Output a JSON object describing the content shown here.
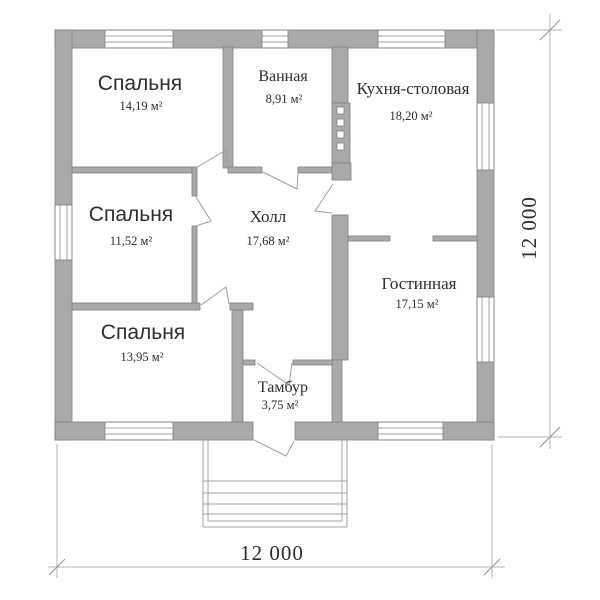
{
  "rooms": [
    {
      "id": "bedroom-1",
      "name": "Спальня",
      "area": "14,19 м²"
    },
    {
      "id": "bathroom",
      "name": "Ванная",
      "area": "8,91 м²"
    },
    {
      "id": "kitchen-dining",
      "name": "Кухня-столовая",
      "area": "18,20 м²"
    },
    {
      "id": "bedroom-2",
      "name": "Спальня",
      "area": "11,52 м²"
    },
    {
      "id": "hall",
      "name": "Холл",
      "area": "17,68 м²"
    },
    {
      "id": "living-room",
      "name": "Гостинная",
      "area": "17,15 м²"
    },
    {
      "id": "bedroom-3",
      "name": "Спальня",
      "area": "13,95 м²"
    },
    {
      "id": "vestibule",
      "name": "Тамбур",
      "area": "3,75 м²"
    }
  ],
  "dimensions": {
    "right": "12 000",
    "bottom": "12 000"
  },
  "colors": {
    "wall": "#a9a9a9",
    "wall_outline": "#818181",
    "dimension_line": "#b5b5b5",
    "text": "#2e2e2e",
    "background": "#ffffff"
  }
}
